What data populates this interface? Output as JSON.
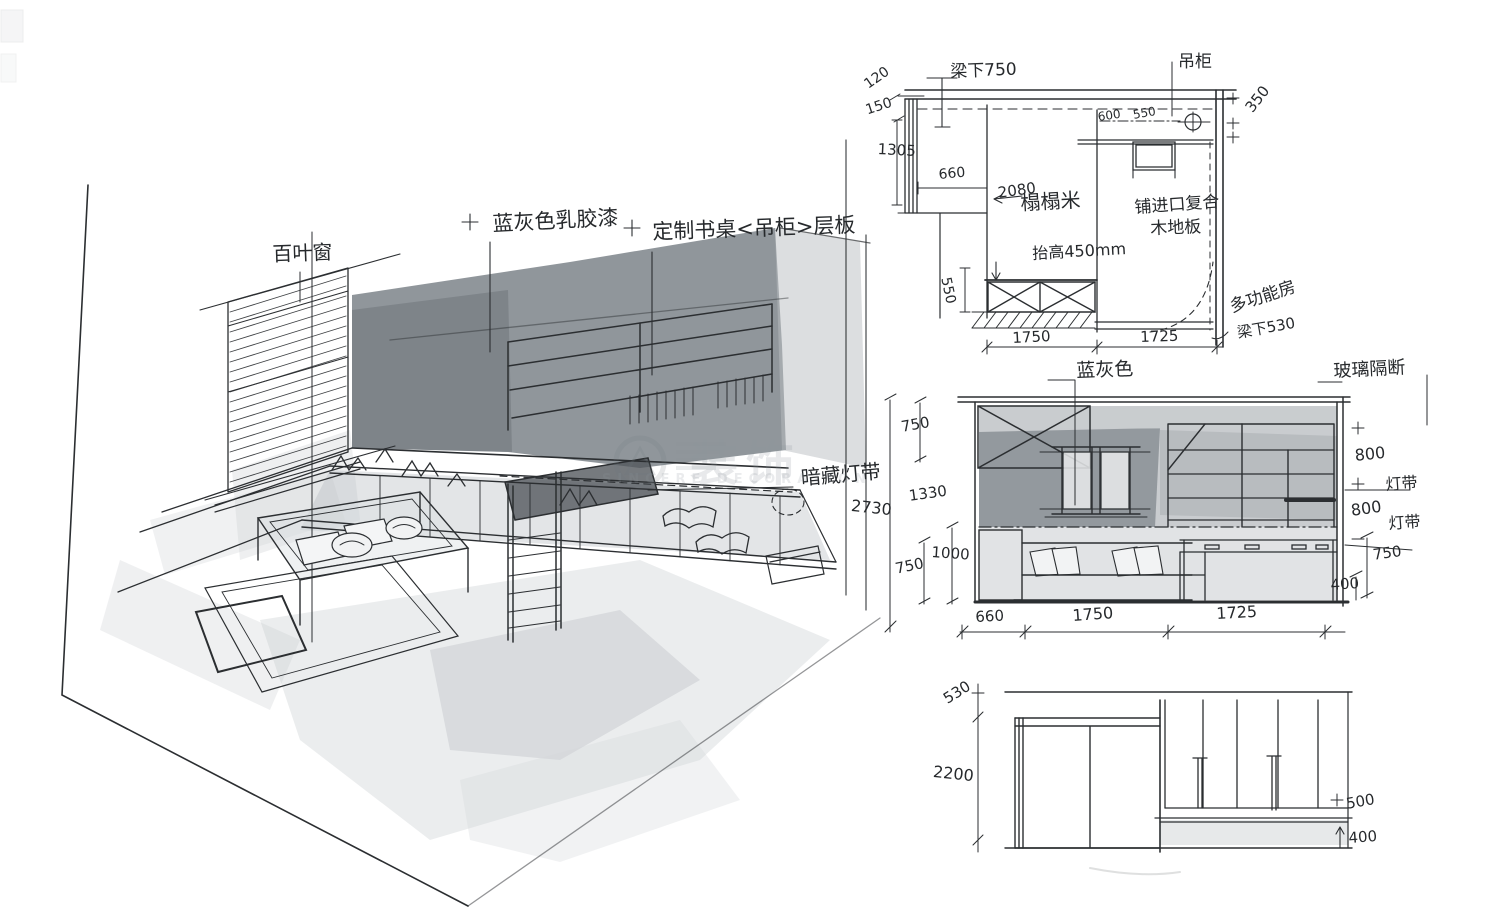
{
  "perspective": {
    "labels": {
      "blinds": "百叶窗",
      "paint": "蓝灰色乳胶漆",
      "desk_shelf": "定制书桌<吊柜>层板",
      "hidden_strip": "暗藏灯带"
    }
  },
  "plan": {
    "labels": {
      "beam": "梁下750",
      "cabinet": "吊柜",
      "tatami": "榻榻米",
      "floor1": "铺进口复合",
      "floor2": "木地板",
      "raised": "抬高450mm",
      "room": "多功能房",
      "beam_low": "梁下530"
    },
    "dims": {
      "d120": "120",
      "d150": "150",
      "d1305": "1305",
      "d660": "660",
      "d2080": "2080",
      "d600": "600",
      "d550_cab": "550",
      "d350": "350",
      "d550_left": "550",
      "d1750": "1750",
      "d1725": "1725"
    }
  },
  "elevation_mid": {
    "labels": {
      "paint": "蓝灰色",
      "glass": "玻璃隔断",
      "strip_a": "灯带",
      "strip_b": "灯带"
    },
    "dims": {
      "total": "2730",
      "left_750_top": "750",
      "left_1330": "1330",
      "left_1000": "1000",
      "left_750_bottom": "750",
      "right_800_top": "800",
      "right_800_bottom": "800",
      "right_750": "750",
      "right_400": "400",
      "bottom_660": "660",
      "bottom_1750": "1750",
      "bottom_1725": "1725"
    }
  },
  "elevation_bottom": {
    "dims": {
      "beam_530": "530",
      "height_2200": "2200",
      "right_500": "500",
      "right_400": "400"
    }
  },
  "watermark": {
    "cn": "装饰",
    "en": "SINCERE DECORATION"
  }
}
